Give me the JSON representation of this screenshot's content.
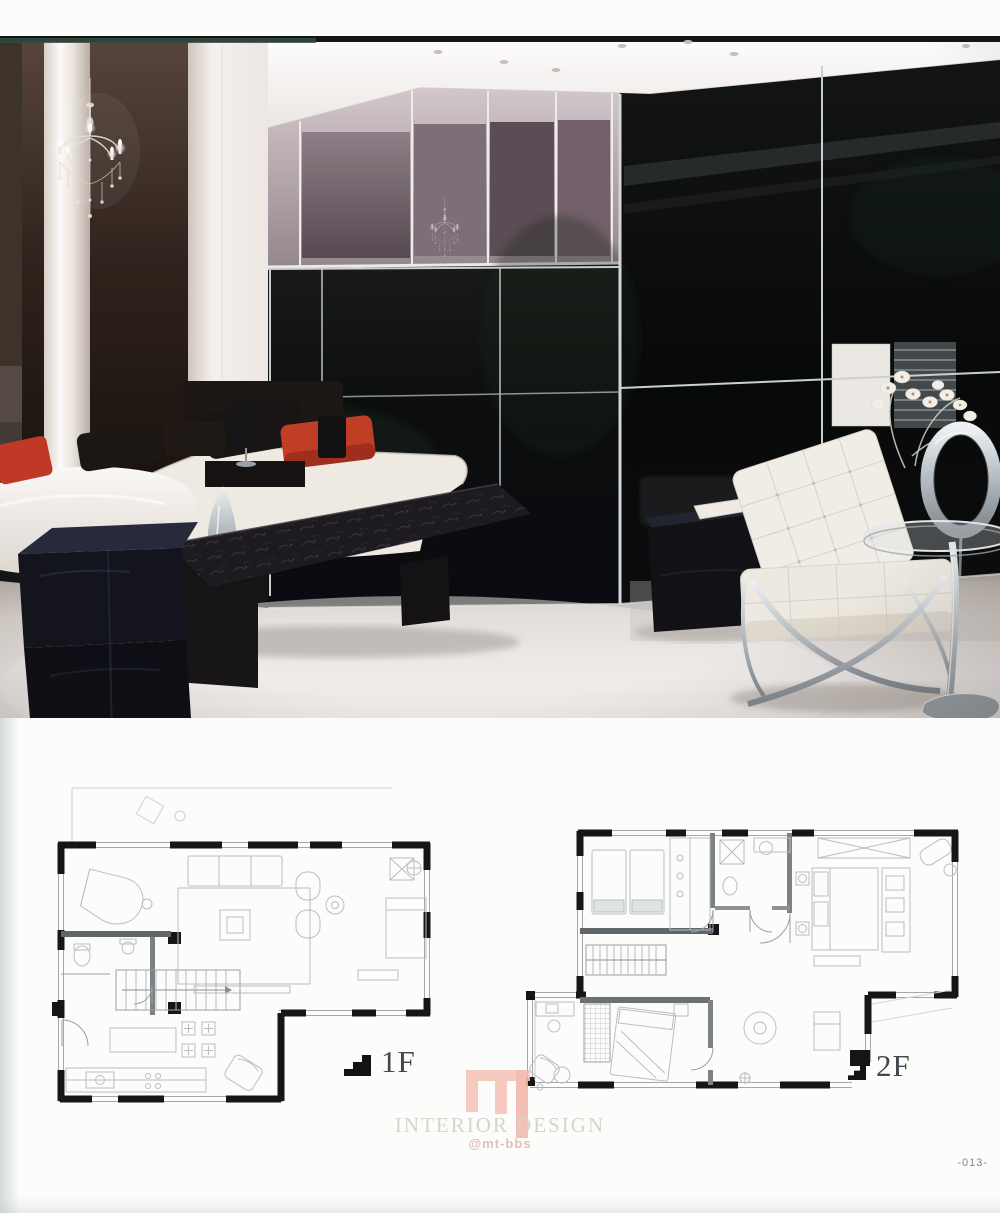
{
  "page": {
    "number": "-013-"
  },
  "photo": {
    "alt": "modern bedroom with black glass wardrobe wall, crystal chandelier, white daybeds with red cushions, leather bench, velvet cube ottomans, white Barcelona chair, glass side table and orchid"
  },
  "floor_plans": {
    "plan1": {
      "label": "1F"
    },
    "plan2": {
      "label": "2F"
    }
  },
  "watermark": {
    "title": "INTERIOR DESIGN",
    "handle": "@mt-bbs"
  },
  "colors": {
    "accent_red": "#c23a22",
    "glass_black": "#07090a",
    "watermark_pink": "#f6c5ba",
    "watermark_text": "#d7d3cf",
    "plan_wall": "#161616"
  }
}
